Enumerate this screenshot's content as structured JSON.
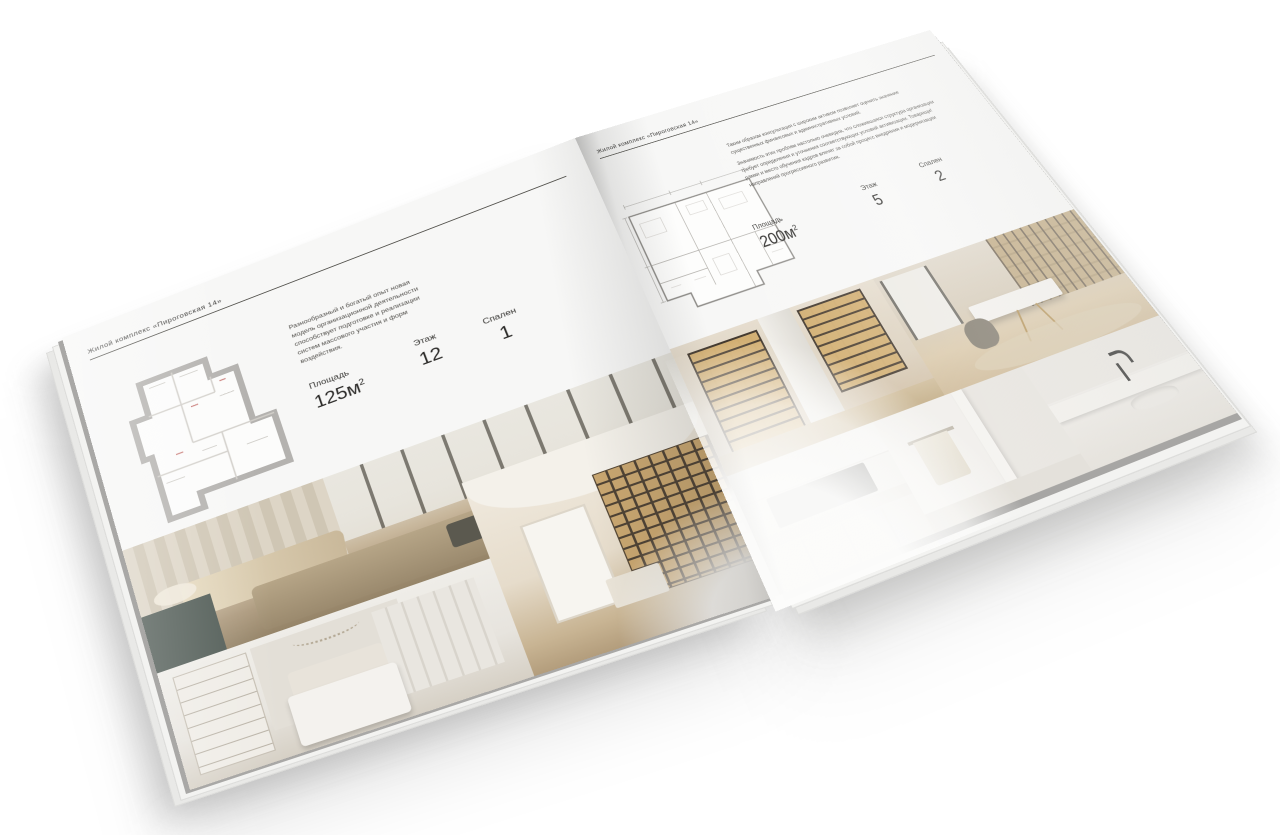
{
  "scene": {
    "background": "#ffffff",
    "paper_color": "#f7f7f6",
    "rule_color": "#55544f"
  },
  "left_page": {
    "header": "Жилой комплекс «Пироговская 14»",
    "description": "Разнообразный и богатый опыт новая модель организационной деятельности способствует подготовке и реализации систем массового участия и форм воздействия.",
    "stats": [
      {
        "label": "Площадь",
        "value": "125м",
        "sup": "2"
      },
      {
        "label": "Этаж",
        "value": "12",
        "sup": ""
      },
      {
        "label": "Спален",
        "value": "1",
        "sup": ""
      }
    ],
    "floor_plan": "apartment-floor-plan-125",
    "photos": [
      "bedroom-interior",
      "hallway-bookshelf-interior",
      "white-bedroom-interior"
    ]
  },
  "right_page": {
    "header": "Жилой комплекс «Пироговская 14»",
    "description_p1": "Таким образом консультация с широким активом позволяет оценить значение существенных финансовых и административных условий.",
    "description_p2": "Значимость этих проблем настолько очевидна, что сложившаяся структура организации требует определения и уточнения соответствующих условий активизации. Товарищи! рамки и место обучения кадров влечет за собой процесс внедрения и модернизации направлений прогрессивного развития.",
    "stats": [
      {
        "label": "Площадь",
        "value": "200м",
        "sup": "2"
      },
      {
        "label": "Этаж",
        "value": "5",
        "sup": ""
      },
      {
        "label": "Спален",
        "value": "2",
        "sup": ""
      }
    ],
    "floor_plan": "apartment-floor-plan-200",
    "photos": [
      "kitchen-cabinet-interior",
      "study-desk-interior",
      "kitchen-detail",
      "bathroom-interior",
      "vanity-marble-detail"
    ]
  }
}
